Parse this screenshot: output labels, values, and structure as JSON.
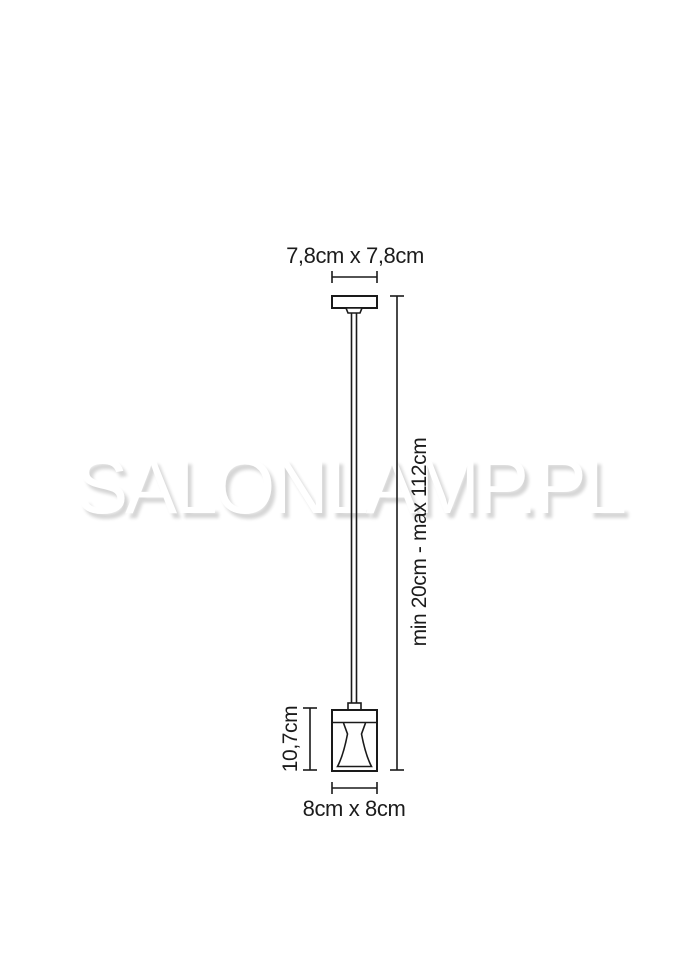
{
  "watermark": {
    "text": "SALONLAMP.PL"
  },
  "labels": {
    "canopy_size": "7,8cm x 7,8cm",
    "suspension_range": "min 20cm - max 112cm",
    "shade_height": "10,7cm",
    "shade_size": "8cm x 8cm"
  },
  "colors": {
    "line": "#1a1a1a",
    "label_text": "#1c1c1c",
    "watermark_shadow": "#d6d6d6",
    "background": "#ffffff"
  }
}
